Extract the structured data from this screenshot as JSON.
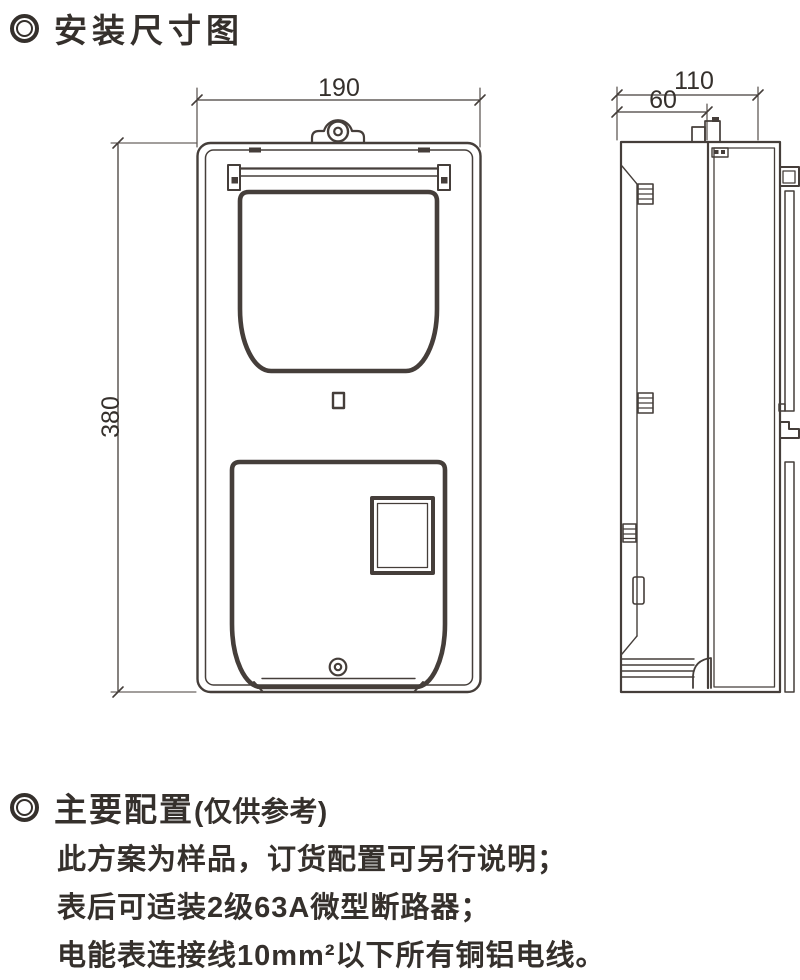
{
  "meta": {
    "background_color": "#ffffff",
    "ink_color": "#35302c",
    "line_color": "#453e3a"
  },
  "sections": {
    "install": {
      "title": "安装尺寸图"
    },
    "config": {
      "title": "主要配置",
      "note": "(仅供参考)",
      "lines": [
        "此方案为样品，订货配置可另行说明；",
        "表后可适装2级63A微型断路器；",
        "电能表连接线10mm²以下所有铜铝电线。"
      ]
    }
  },
  "diagram": {
    "front_view": {
      "width_mm": "190",
      "height_mm": "380"
    },
    "side_view": {
      "depth_mm": "110",
      "mount_offset_mm": "60"
    }
  }
}
